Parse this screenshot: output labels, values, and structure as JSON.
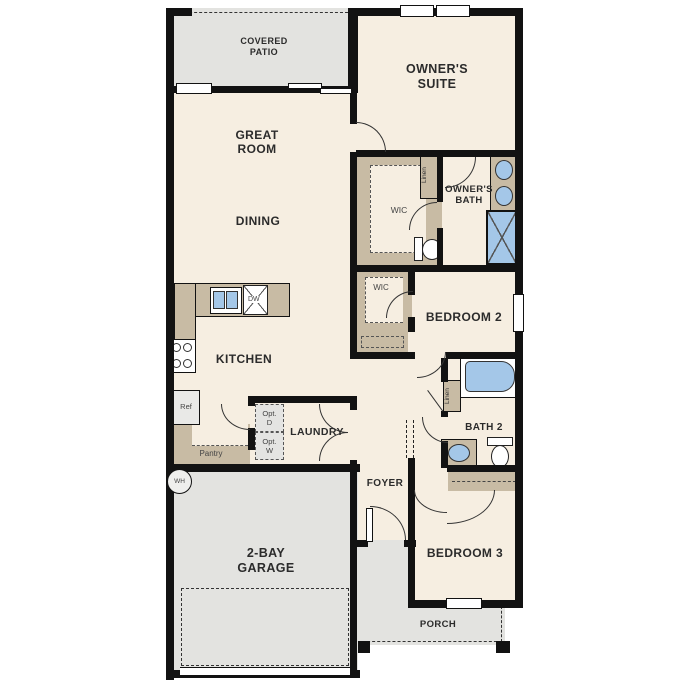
{
  "plan": {
    "rooms": {
      "covered_patio": {
        "line1": "COVERED",
        "line2": "PATIO"
      },
      "owners_suite": {
        "line1": "OWNER'S",
        "line2": "SUITE"
      },
      "great_room": {
        "line1": "GREAT",
        "line2": "ROOM"
      },
      "dining": {
        "label": "DINING"
      },
      "kitchen": {
        "label": "KITCHEN"
      },
      "owners_wic": {
        "label": "WIC"
      },
      "owners_bath": {
        "line1": "OWNER'S",
        "line2": "BATH"
      },
      "bedroom2": {
        "label": "BEDROOM 2"
      },
      "bedroom2_wic": {
        "label": "WIC"
      },
      "laundry": {
        "label": "LAUNDRY"
      },
      "bath2": {
        "label": "BATH 2"
      },
      "foyer": {
        "label": "FOYER"
      },
      "bedroom3": {
        "label": "BEDROOM 3"
      },
      "garage": {
        "line1": "2-BAY",
        "line2": "GARAGE"
      },
      "porch": {
        "label": "PORCH"
      }
    },
    "fixtures": {
      "linen_owners": "Linen",
      "linen_bath2": "Linen",
      "refrigerator": "Ref",
      "pantry": "Pantry",
      "dishwasher": "DW",
      "water_heater": "WH",
      "opt_dryer": {
        "line1": "Opt.",
        "line2": "D"
      },
      "opt_washer": {
        "line1": "Opt.",
        "line2": "W"
      }
    },
    "colors": {
      "room_fill": "#F6EEE1",
      "casework_tan": "#C8BBA4",
      "exterior_gray": "#E3E3E0",
      "fixture_blue": "#A4C7E8",
      "wall_black": "#121212"
    }
  }
}
